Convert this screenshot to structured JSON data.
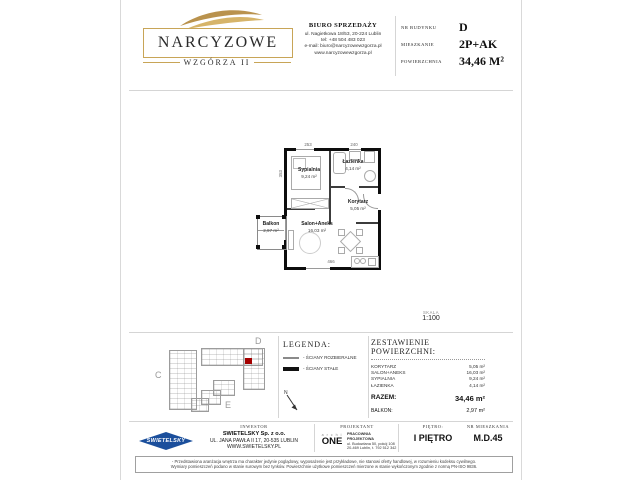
{
  "colors": {
    "gold": "#c8a557",
    "investor_blue": "#1b4f9c",
    "highlight_red": "#a40000"
  },
  "header": {
    "logo": {
      "title": "NARCYZOWE",
      "subtitle": "WZGÓRZA II"
    },
    "office": {
      "title": "BIURO SPRZEDAŻY",
      "lines": [
        "ul. Nagietkowa 18/53, 20-224 Lublin",
        "tel: +48 504 483 023",
        "e-mail: biuro@narcyzowewzgorza.pl",
        "www.narcyzowewzgorza.pl"
      ]
    },
    "unit": {
      "building_label": "NR BUDYNKU",
      "building_value": "D",
      "apartment_label": "MIESZKANIE",
      "apartment_value": "2P+AK",
      "area_label": "POWIERZCHNIA",
      "area_value": "34,46 M²"
    }
  },
  "plan": {
    "rooms": [
      {
        "name": "Sypialnia",
        "area": "9,24 m²"
      },
      {
        "name": "Łazienka",
        "area": "4,14 m²"
      },
      {
        "name": "Korytarz",
        "area": "5,05 m²"
      },
      {
        "name": "Salon+Aneks",
        "area": "16,03 m²"
      },
      {
        "name": "Balkon",
        "area": "2,97 m²"
      }
    ],
    "dims": {
      "top_left": "253",
      "top_right": "240",
      "bottom": "466",
      "left": "353"
    },
    "scale": {
      "label": "SKALA",
      "value": "1:100"
    }
  },
  "keyplan": {
    "labels": {
      "c": "C",
      "d": "D",
      "e": "E"
    }
  },
  "legend": {
    "title": "LEGENDA:",
    "items": [
      {
        "label": "- ŚCIANY ROZBIERALNE"
      },
      {
        "label": "- ŚCIANY STAŁE"
      }
    ],
    "north": "N"
  },
  "summary": {
    "title": "ZESTAWIENIE POWIERZCHNI:",
    "rows": [
      {
        "label": "KORYTARZ",
        "value": "5,05 m²"
      },
      {
        "label": "SALON+ANEKS",
        "value": "16,03 m²"
      },
      {
        "label": "SYPIALNIA",
        "value": "9,24 m²"
      },
      {
        "label": "ŁAZIENKA",
        "value": "4,14 m²"
      }
    ],
    "total_label": "RAZEM:",
    "total_value": "34,46 m²",
    "balcony_label": "BALKON:",
    "balcony_value": "2,97 m²"
  },
  "footer": {
    "investor_label": "INWESTOR",
    "investor_logo": "SWIETELSKY",
    "investor_name": "SWIETELSKY Sp. z o.o.",
    "investor_address": "UL. JANA PAWŁA II 17, 20-535 LUBLIN",
    "investor_site": "WWW.SWIETELSKY.PL",
    "designer_label": "PROJEKTANT",
    "designer_logo_small": "a r c h i",
    "designer_logo_big": "ONE",
    "designer_lines": [
      "PRACOWNIA PROJEKTOWA",
      "ul. Budowlana 50, pokój 108",
      "20-469 Lublin, t. 792 512 342"
    ],
    "floor_label": "PIĘTRO:",
    "floor_value": "I PIĘTRO",
    "apt_label": "NR MIESZKANIA",
    "apt_value": "M.D.45",
    "disclaimer": [
      "- Przedstawiona aranżacja wnętrza ma charakter jedynie poglądowy, wyposażenie jest przykładowe, nie stanowi oferty handlowej, w rozumieniu kodeksu cywilnego.",
      "Wymiary pomieszczeń podano w stanie surowym bez tynków. Powierzchnie użytkowe pomieszczeń mierzone w stanie wykończonym zgodnie z normą PN-ISO 9836."
    ]
  }
}
